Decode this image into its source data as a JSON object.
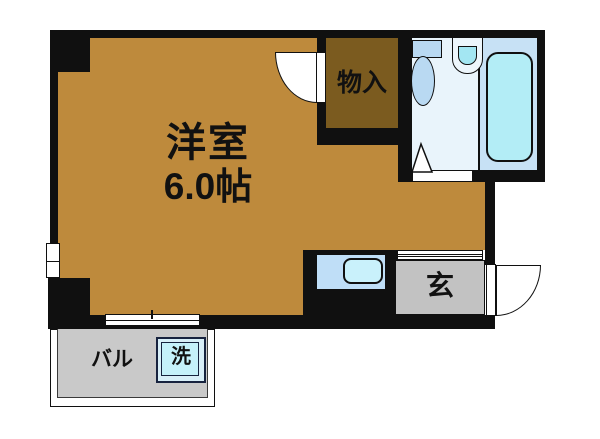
{
  "floorplan": {
    "type": "apartment-floor-plan",
    "rooms": {
      "main": {
        "name": "洋室",
        "size": "6.0帖"
      },
      "closet": {
        "label": "物入"
      },
      "entrance": {
        "label": "玄"
      },
      "balcony": {
        "label": "バル"
      },
      "washer": {
        "label": "洗"
      }
    },
    "colors": {
      "wall": "#101010",
      "room_floor": "#BE8A3C",
      "closet_floor": "#7B5B1F",
      "bath_floor": "#E9F4FB",
      "tub_zone": "#C7E1F5",
      "fixture": "#B9D9F2",
      "tub": "#B3EDF6",
      "sink_bowl": "#A3E6F2",
      "kitchen_unit": "#BFDEF7",
      "kitchen_sink": "#C9F1FB",
      "entrance_floor": "#C2C2C2",
      "balcony_floor": "#C9C9C9",
      "washer": "#C5F1FA",
      "door": "#FFFFFF"
    }
  }
}
